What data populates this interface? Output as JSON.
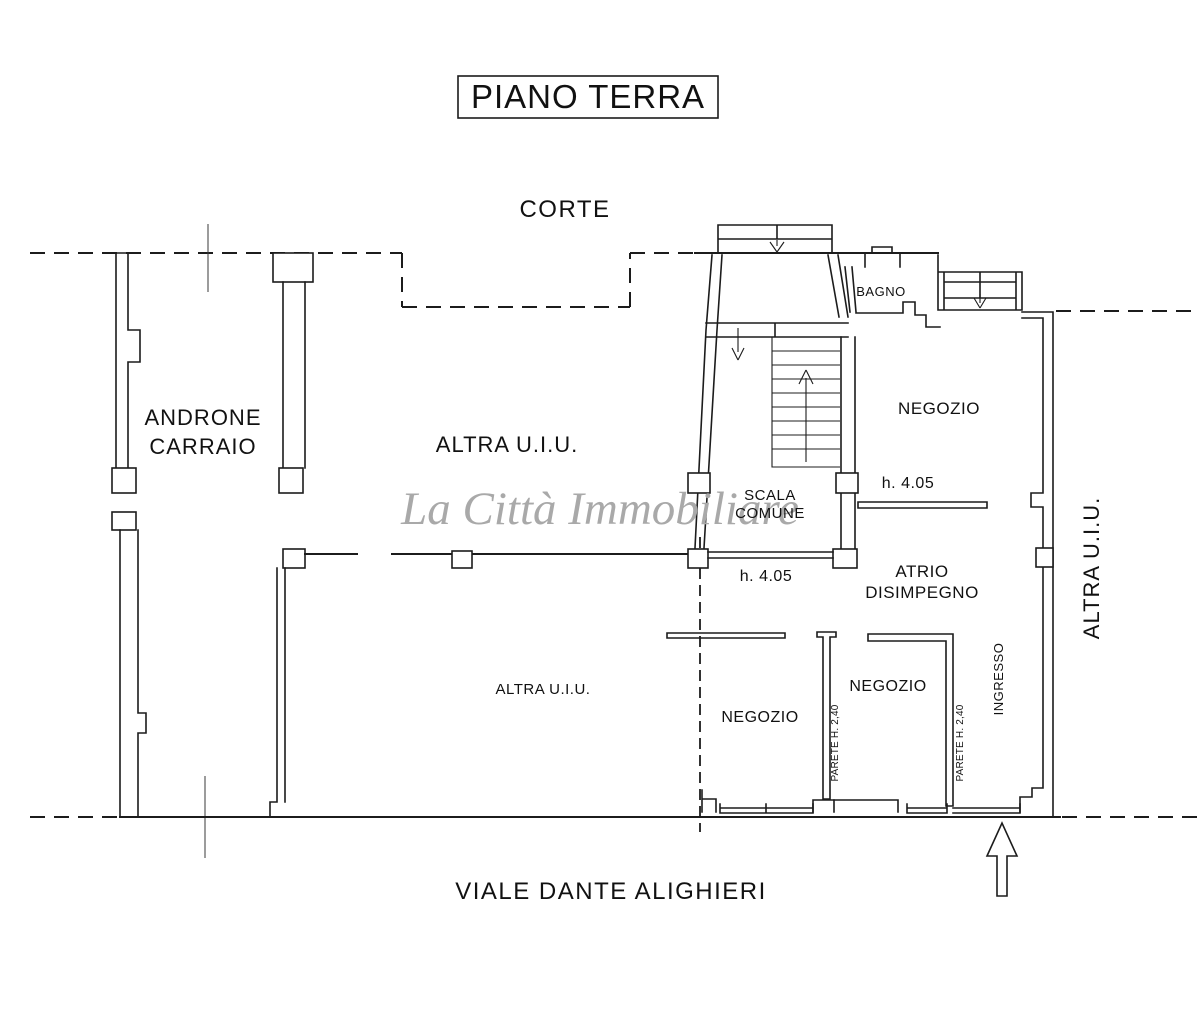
{
  "header": {
    "title": "PIANO TERRA"
  },
  "streets": {
    "top": "CORTE",
    "bottom": "VIALE DANTE ALIGHIERI"
  },
  "watermark": {
    "text": "La Città Immobiliare",
    "color": "#a9a9a9"
  },
  "rooms": {
    "androne_line1": "ANDRONE",
    "androne_line2": "CARRAIO",
    "altra_uiu_center": "ALTRA U.I.U.",
    "altra_uiu_lower": "ALTRA U.I.U.",
    "altra_uiu_right": "ALTRA U.I.U.",
    "scala_line1": "SCALA",
    "scala_line2": "COMUNE",
    "bagno": "BAGNO",
    "negozio_top": "NEGOZIO",
    "negozio_left": "NEGOZIO",
    "negozio_middle": "NEGOZIO",
    "atrio_line1": "ATRIO",
    "atrio_line2": "DISIMPEGNO",
    "ingresso": "INGRESSO"
  },
  "annotations": {
    "height_stair": "h. 4.05",
    "height_shop": "h. 4.05",
    "parete_left": "PARETE H. 2,40",
    "parete_right": "PARETE H. 2,40"
  },
  "colors": {
    "line": "#1c1c1c",
    "centerline": "#3a3a3a",
    "watermark": "#a9a9a9"
  }
}
